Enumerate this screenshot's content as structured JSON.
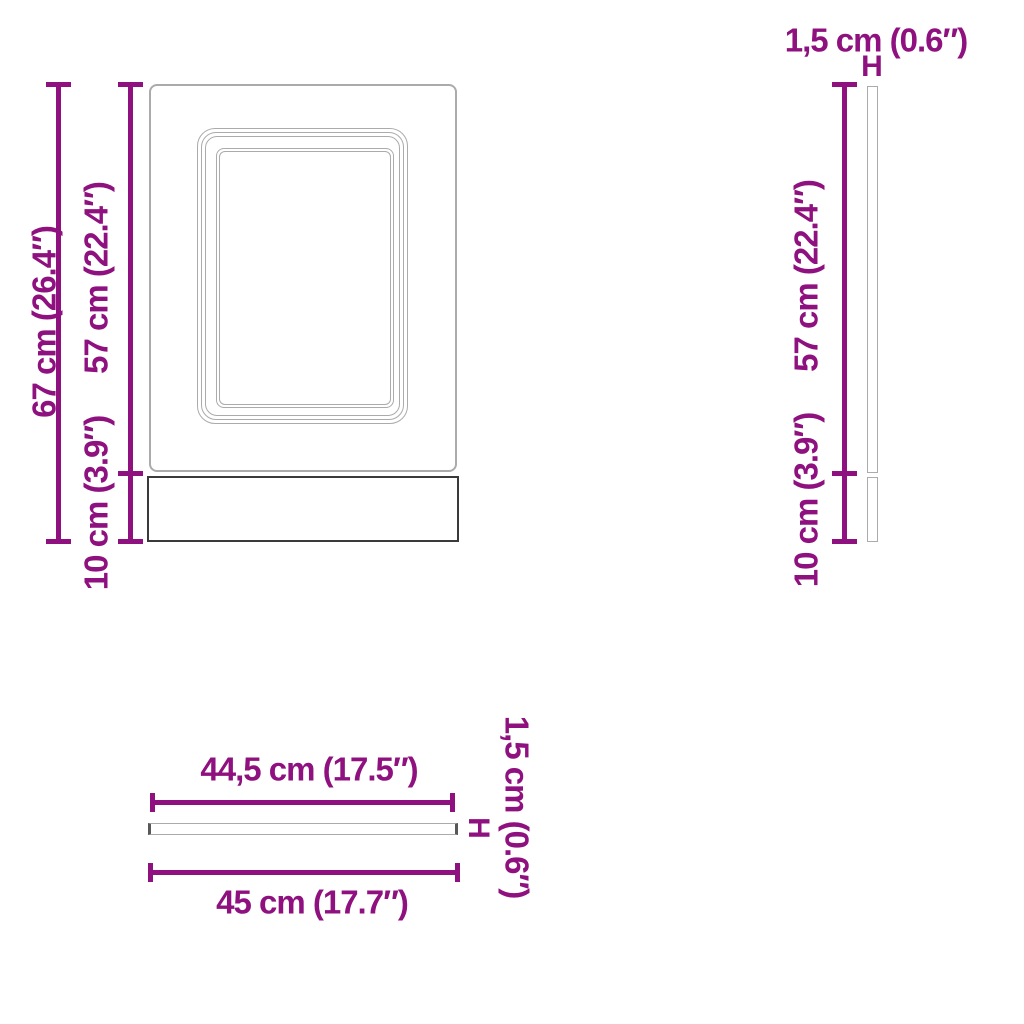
{
  "colors": {
    "dimension": "#8E117F",
    "outline_light": "#ABABAB",
    "outline_dark": "#3A3A3A",
    "background": "#FFFFFF"
  },
  "front_view": {
    "total_height_label": "67 cm (26.4″)",
    "door_height_label": "57 cm (22.4″)",
    "plinth_height_label": "10 cm (3.9″)"
  },
  "side_view": {
    "thickness_label": "1,5 cm (0.6″)",
    "door_height_label": "57 cm (22.4″)",
    "plinth_height_label": "10 cm (3.9″)",
    "thickness_marker": "H"
  },
  "top_view": {
    "door_width_label": "44,5 cm (17.5″)",
    "total_width_label": "45 cm (17.7″)",
    "thickness_label": "1,5 cm (0.6″)",
    "thickness_marker": "H"
  }
}
